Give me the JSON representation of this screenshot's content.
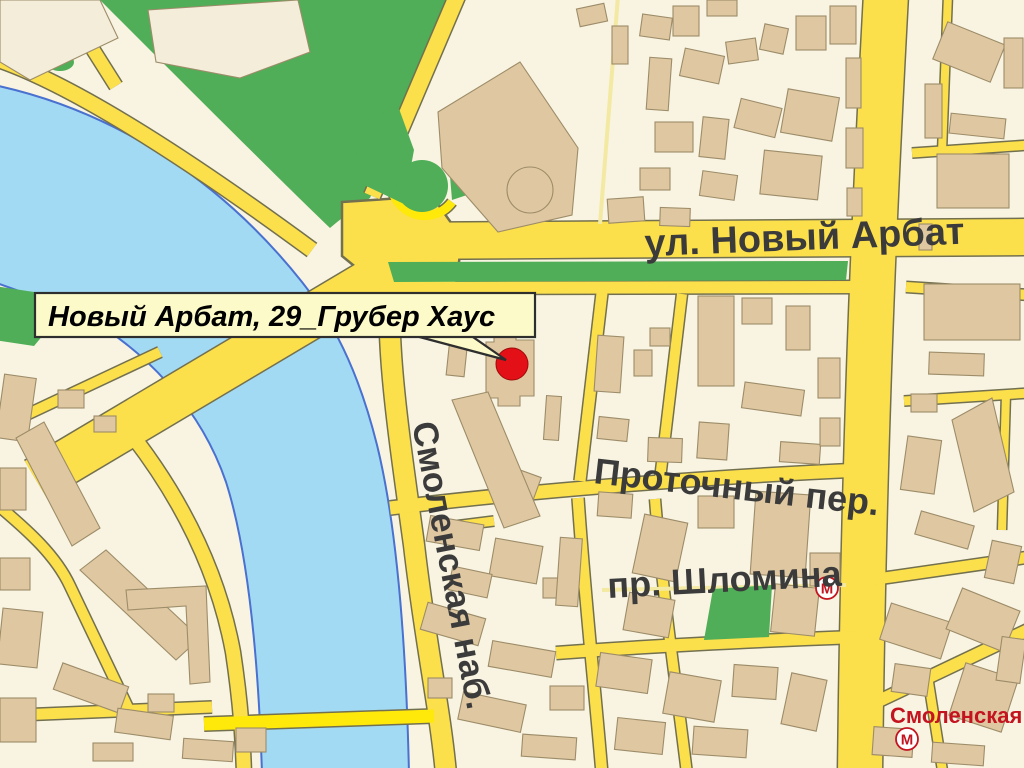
{
  "callout": {
    "label": "Новый Арбат, 29_Грубер Хаус"
  },
  "streets": {
    "novy_arbat": "ул. Новый Арбат",
    "protochny": "Проточный пер.",
    "shlomina": "пр. Шломина",
    "smolenskaya_nab": "Смоленская наб."
  },
  "metro": {
    "station_label": "Смоленская",
    "symbol": "М"
  },
  "colors": {
    "background": "#F8F4E1",
    "water": "#A3DAF3",
    "water_stroke": "#4A70D0",
    "green": "#4FAE57",
    "road": "#FBDF4B",
    "road_casing": "#73704F",
    "road_bright": "#FFE90A",
    "lane": "#F3E9A2",
    "building": "#DFC8A1",
    "building_stroke": "#9D8C69",
    "building_light": "#F3EDDA",
    "label_gray": "#3B3B3B",
    "metro_red": "#C41420",
    "marker_red": "#E31017",
    "callout_bg": "#FBFAC8",
    "callout_border": "#2E2E2E"
  }
}
